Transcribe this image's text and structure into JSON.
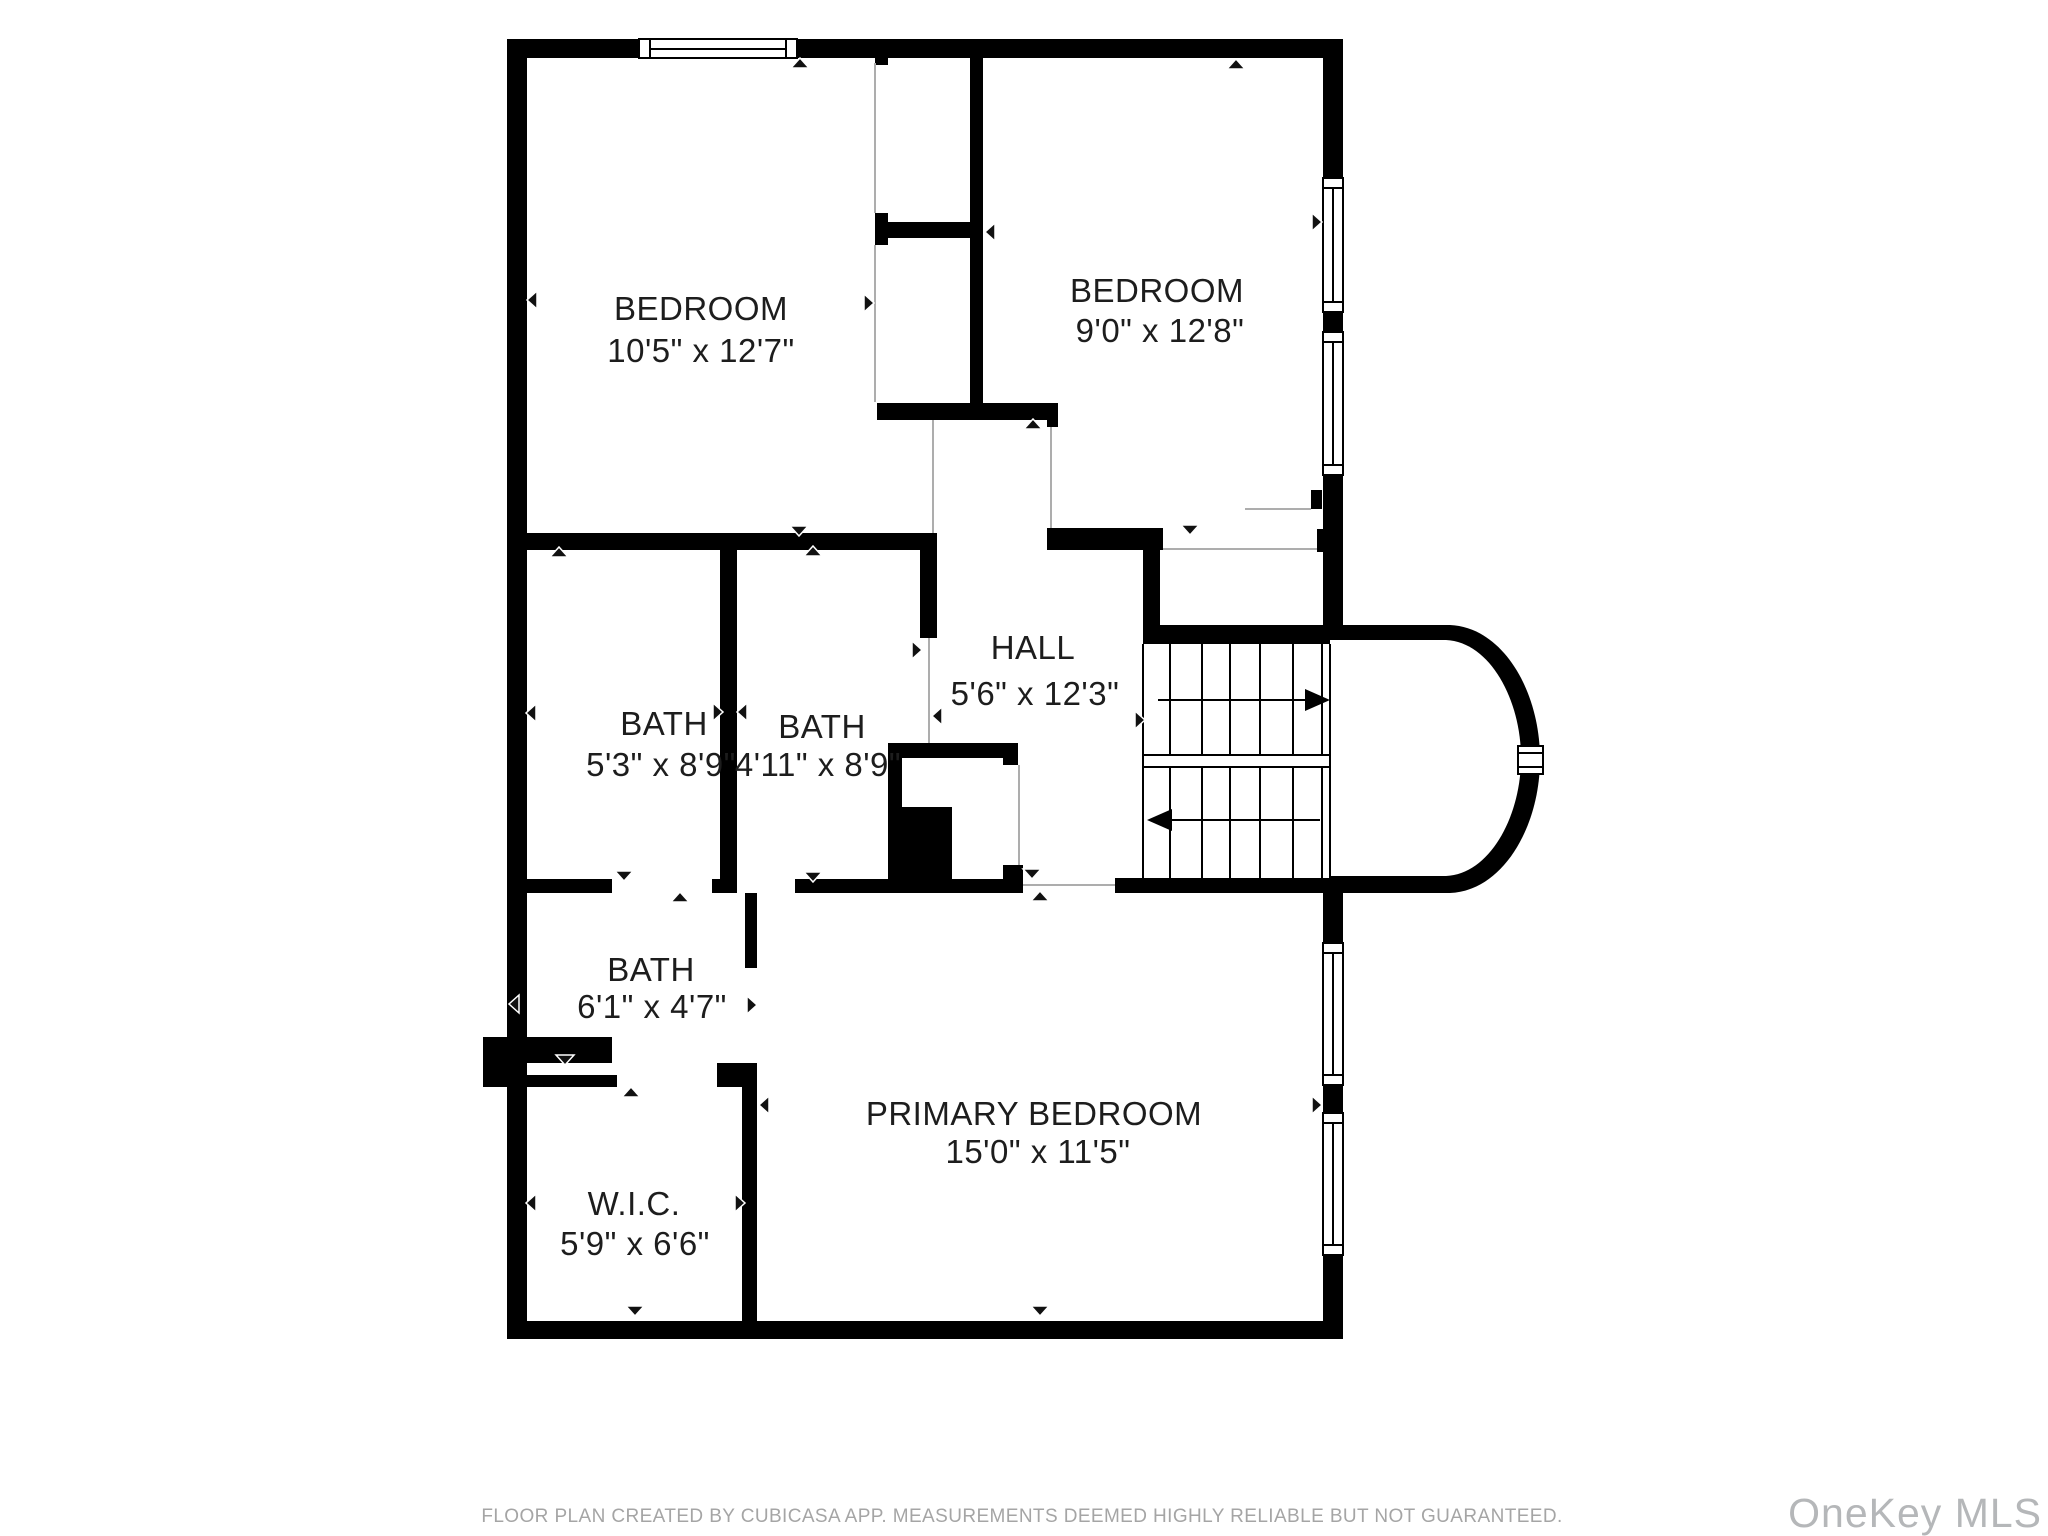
{
  "floor_plan": {
    "rooms": [
      {
        "name": "BEDROOM",
        "dims": "10'5\" x 12'7\""
      },
      {
        "name": "BEDROOM",
        "dims": "9'0\" x 12'8\""
      },
      {
        "name": "HALL",
        "dims": "5'6\" x 12'3\""
      },
      {
        "name": "BATH",
        "dims": "5'3\" x 8'9\""
      },
      {
        "name": "BATH",
        "dims": "4'11\" x 8'9\""
      },
      {
        "name": "BATH",
        "dims": "6'1\" x 4'7\""
      },
      {
        "name": "W.I.C.",
        "dims": "5'9\" x 6'6\""
      },
      {
        "name": "PRIMARY BEDROOM",
        "dims": "15'0\" x 11'5\""
      }
    ],
    "footer": "FLOOR PLAN CREATED BY CUBICASA APP. MEASUREMENTS DEEMED HIGHLY RELIABLE BUT NOT GUARANTEED.",
    "watermark": "OneKey MLS"
  }
}
